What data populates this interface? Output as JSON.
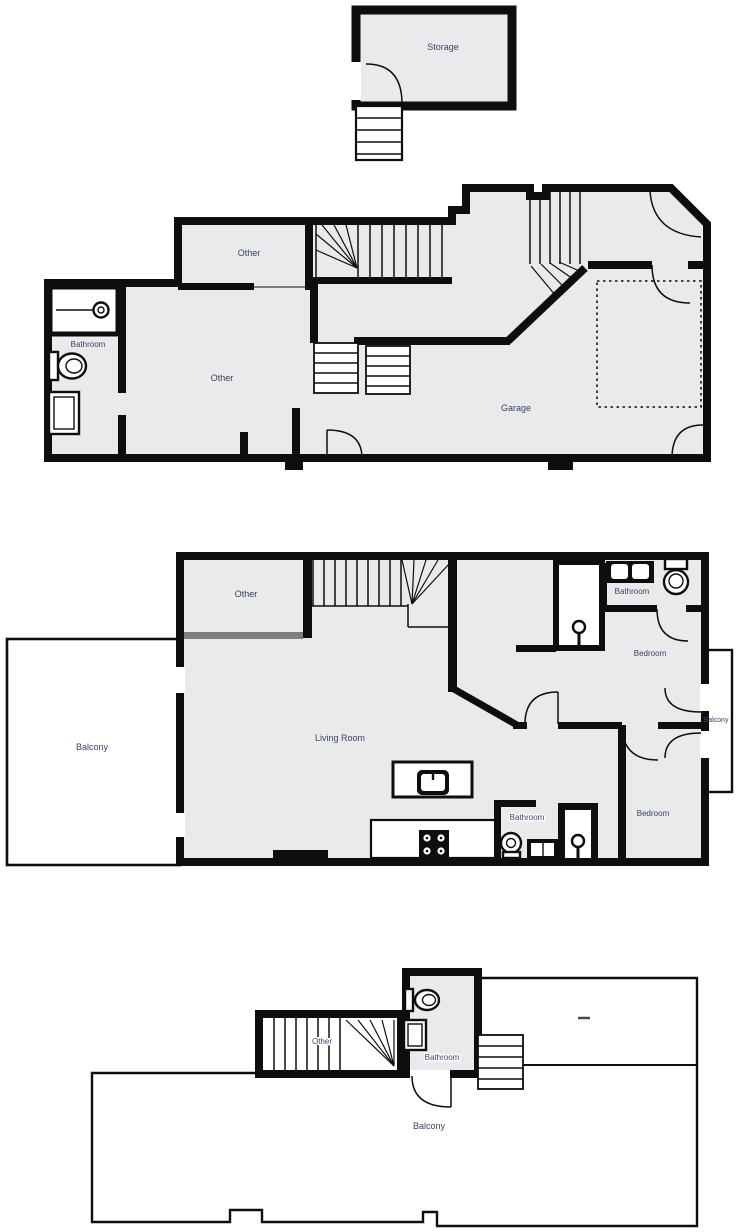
{
  "palette": {
    "wall": "#0e0e0e",
    "room_fill": "#e9eaec",
    "white": "#ffffff",
    "label_color": "#3c4166",
    "gray_wall": "#7e7e7e"
  },
  "labels": {
    "storage": "Storage",
    "b_other_small": "Other",
    "b_bathroom": "Bathroom",
    "b_other_big": "Other",
    "b_garage": "Garage",
    "c_other": "Other",
    "c_living_room": "Living Room",
    "c_balcony_left": "Balcony",
    "c_bathroom_top": "Bathroom",
    "c_bedroom_top": "Bedroom",
    "c_balcony_right": "Balcony",
    "c_bathroom_bottom": "Bathroom",
    "c_bedroom_bottom": "Bedroom",
    "d_other": "Other",
    "d_bathroom": "Bathroom",
    "d_balcony": "Balcony"
  }
}
